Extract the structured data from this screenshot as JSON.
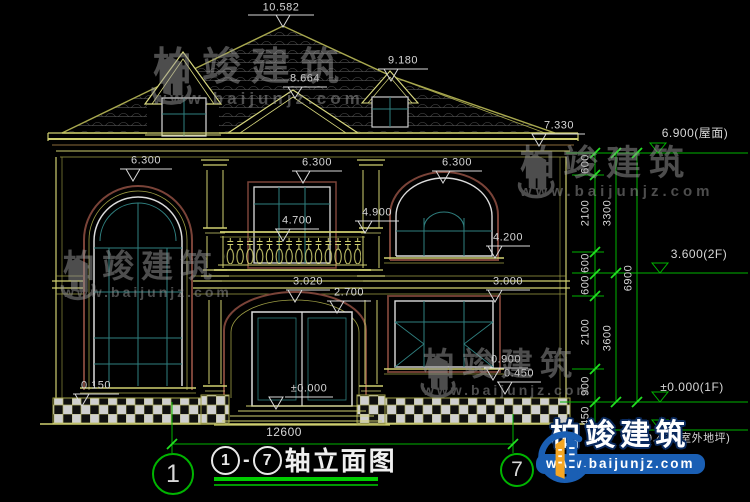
{
  "drawing": {
    "title": {
      "axis_from": "1",
      "axis_to": "7",
      "separator": "-",
      "text": "轴立面图"
    },
    "axis_bubbles": {
      "left": "1",
      "right": "7"
    },
    "overall_width_dim": "12600",
    "elevation_markers": {
      "peak": "10.582",
      "ridge_right": "9.180",
      "porch_gable": "8.664",
      "eave_right": "7.330",
      "window_top_left": "6.300",
      "window_top_center": "6.300",
      "window_top_right": "6.300",
      "column_capital": "4.900",
      "balcony_rail": "4.700",
      "window2_sill_right": "4.200",
      "floor2_right": "3.000",
      "entry_arch": "3.020",
      "entry_top": "2.700",
      "window1_sill_right": "0.900",
      "plinth_right": "0.450",
      "plinth_left": "0.150",
      "entry_ground": "±0.000"
    },
    "level_labels": {
      "roof": "6.900(屋面)",
      "floor2": "3.600(2F)",
      "floor1": "±0.000(1F)",
      "site": "-0.450(室外地坪)"
    },
    "dims": {
      "chain_inner": [
        "600",
        "2100",
        "600",
        "600",
        "2100",
        "900",
        "450"
      ],
      "chain_mid": [
        "3300",
        "3600"
      ],
      "total": "6900"
    }
  },
  "watermark": {
    "brand": "柏竣建筑",
    "url": "www.baijunjz.com"
  },
  "logo": {
    "brand": "柏竣建筑",
    "url": "www.baijunjz.com"
  },
  "colors": {
    "background": "#000000",
    "cad_yellow": "#cfcf70",
    "cad_olive": "#9f9f45",
    "trim_maroon": "#7a4338",
    "glass_teal": "#2f7f7f",
    "frame_white": "#dcdcdc",
    "dim_green": "#00b400",
    "tick_green": "#22e022",
    "text_gray": "#d6d6d6",
    "logo_blue": "#1a5fb4",
    "logo_orange": "#f5a623",
    "watermark_gray": "#9a9a9a"
  }
}
